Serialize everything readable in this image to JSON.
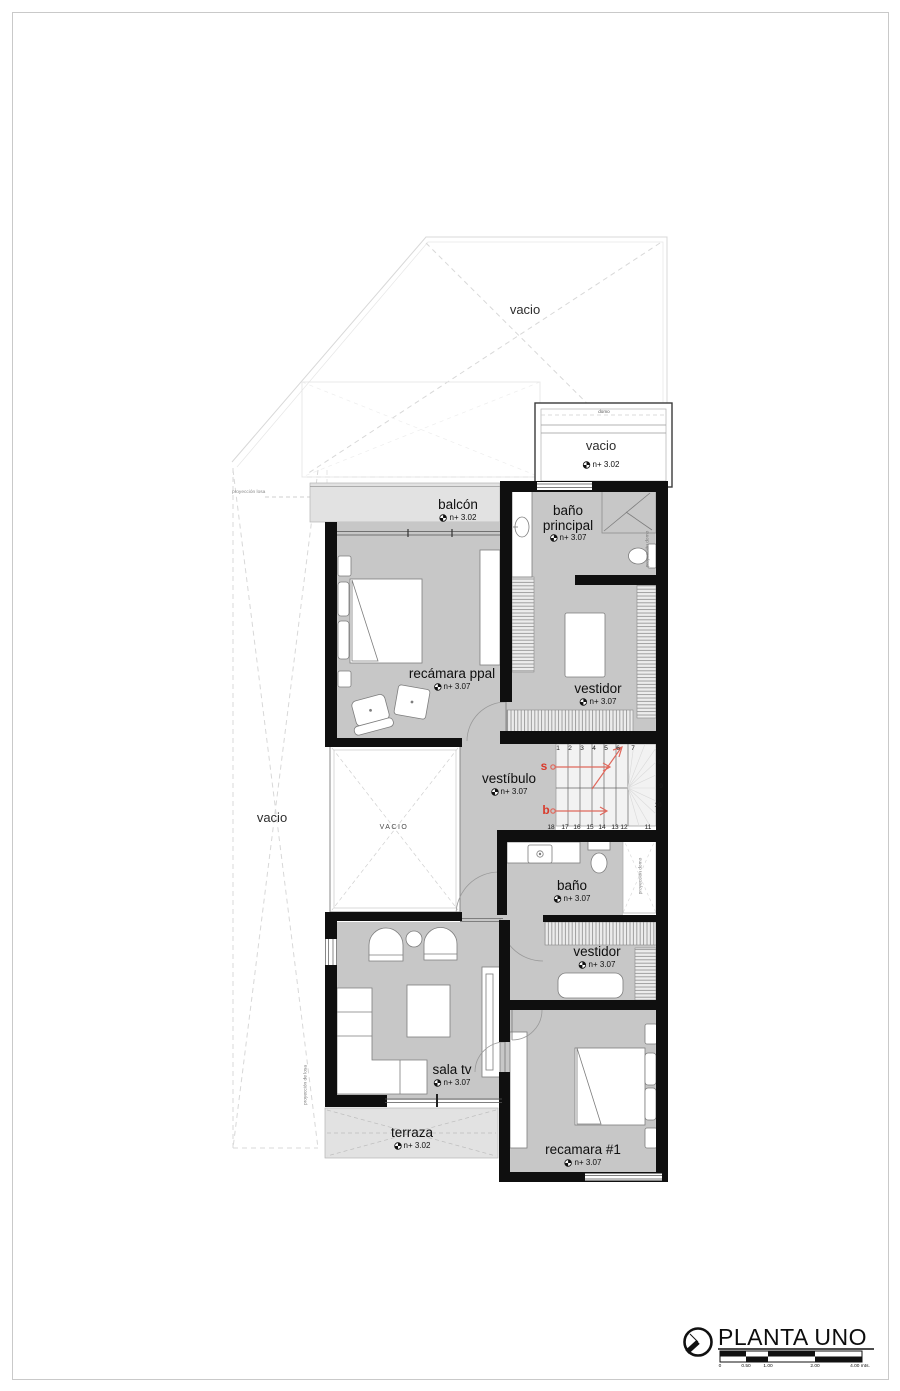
{
  "plan": {
    "rooms": {
      "balcon": {
        "label": "balcón",
        "level": "n+ 3.02"
      },
      "bano_principal": {
        "label_line1": "baño",
        "label_line2": "principal",
        "level": "n+ 3.07"
      },
      "recamara_ppal": {
        "label": "recámara ppal",
        "level": "n+ 3.07"
      },
      "vestidor_norte": {
        "label": "vestidor",
        "level": "n+ 3.07"
      },
      "vestibulo": {
        "label": "vestíbulo",
        "level": "n+ 3.07"
      },
      "bano": {
        "label": "baño",
        "level": "n+ 3.07"
      },
      "vestidor_sur": {
        "label": "vestidor",
        "level": "n+ 3.07"
      },
      "sala_tv": {
        "label": "sala tv",
        "level": "n+ 3.07"
      },
      "recamara_1": {
        "label": "recamara #1",
        "level": "n+ 3.07"
      },
      "terraza": {
        "label": "terraza",
        "level": "n+ 3.02"
      }
    },
    "voids": {
      "vacio_techo": "vacio",
      "vacio_lateral": "vacio",
      "vacio_interior": "VACIO",
      "domo": {
        "label": "domo",
        "vacio": "vacio",
        "level": "n+ 3.02"
      }
    },
    "projections": {
      "losa": "proyección losa",
      "de_losa": "proyección de losa",
      "domo_bano_principal": "proyección domo",
      "domo_bano": "proyección domo"
    },
    "stairs": {
      "up_label": "s",
      "down_label": "b",
      "steps_top": [
        "1",
        "2",
        "3",
        "4",
        "5",
        "6",
        "7"
      ],
      "steps_side": [
        "8",
        "9",
        "10"
      ],
      "steps_bottom": [
        "18",
        "17",
        "16",
        "15",
        "14",
        "13",
        "12",
        "11"
      ]
    }
  },
  "titleblock": {
    "title": "PLANTA UNO",
    "scale_ticks": [
      "0",
      "0.50",
      "1.00",
      "2.00",
      "4.00 mts."
    ]
  },
  "colors": {
    "floor_gray": "#c7c7c7",
    "outdoor_gray": "#e2e2e2",
    "wall_black": "#0f0f0f",
    "stair_arrow_red": "#d93a2b"
  }
}
